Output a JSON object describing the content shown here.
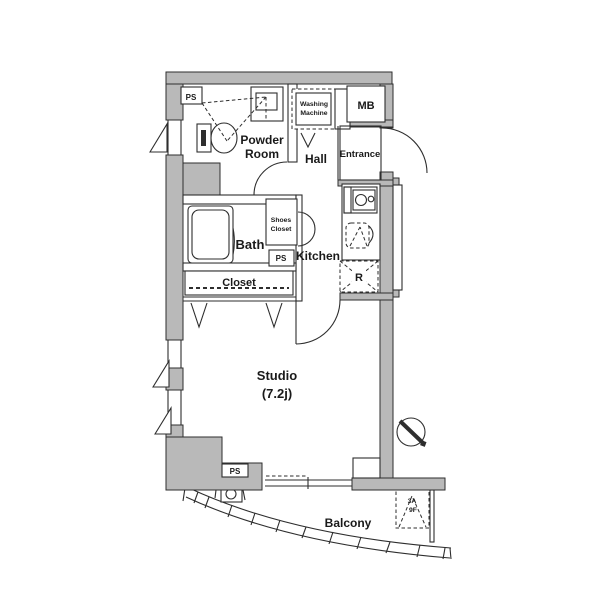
{
  "plan": {
    "title": "studio-apartment-floor-plan",
    "colors": {
      "wall_fill": "#b9b9b9",
      "line": "#2e2e2e",
      "background": "#ffffff"
    },
    "labels": {
      "ps_top": "PS",
      "washing_line1": "Washing",
      "washing_line2": "Machine",
      "mb": "MB",
      "powder_line1": "Powder",
      "powder_line2": "Room",
      "hall": "Hall",
      "entrance": "Entrance",
      "bath": "Bath",
      "shoes_line1": "Shoes",
      "shoes_line2": "Closet",
      "ps_mid": "PS",
      "kitchen": "Kitchen",
      "fridge": "R",
      "closet": "Closet",
      "studio_line1": "Studio",
      "studio_line2": "(7.2j)",
      "ps_bottom": "PS",
      "balcony": "Balcony",
      "hatch_line1": "3A",
      "hatch_line2": "9F"
    }
  }
}
